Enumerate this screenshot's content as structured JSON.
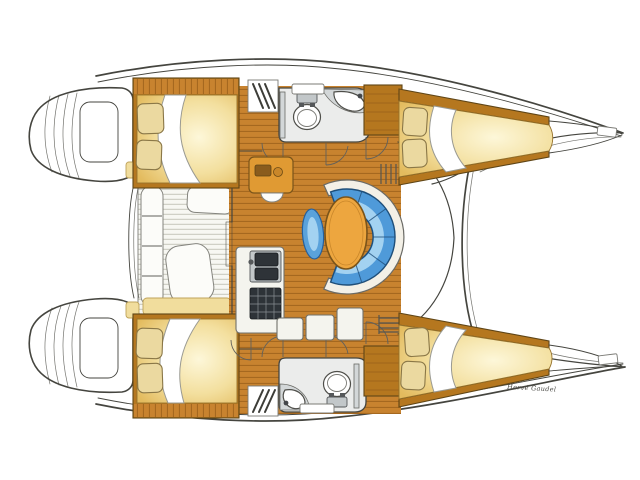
{
  "signature": "Hervé Gaudel",
  "palette": {
    "paper": "#ffffff",
    "outline": "#45453f",
    "wood": "#c8832f",
    "wood_grain": "#9a5f1a",
    "wood_trim": "#b5771f",
    "wood_edge": "#5f4516",
    "mattress": "#f3df9e",
    "mattress_glow": "#fdf7d9",
    "mattress_edge": "#e3bb5e",
    "pillow": "#ebd9a0",
    "pillow_line": "#8a7747",
    "sheet_edge": "#9a9a92",
    "head_floor": "#ebeceb",
    "fixture_gray": "#d3d7d8",
    "sink_steel": "#c2c7c9",
    "counter_white": "#f4f4ee",
    "slat_floor": "#f7f7f2",
    "slat_line": "#c6c6bb",
    "cushion_white": "#fcfcf9",
    "cushion_edge": "#84847e",
    "sun_cushion": "#f1dd9d",
    "sun_edge": "#bfa35a",
    "settee_back": "#f3f0e7",
    "settee_blue": "#4f9ad9",
    "settee_blue_light": "#a8d5f2",
    "settee_blue_edge": "#1f4f7a",
    "stool_blue": "#5aa2db",
    "table_orange": "#eda63f",
    "table_edge": "#7a541a",
    "chart_orange": "#e09a33",
    "steel_dark": "#2e3338",
    "signature_ink": "#4a4a45"
  },
  "features": {
    "port_hull": [
      "aft-double-berth",
      "companionway-steps",
      "head-toilet-sink",
      "wardrobe",
      "forward-double-berth"
    ],
    "starboard_hull": [
      "aft-double-berth",
      "companionway-steps",
      "head-toilet-sink",
      "wardrobe",
      "forward-double-berth"
    ],
    "saloon": [
      "chart-table",
      "c-shaped-settee",
      "oval-table",
      "stool",
      "galley-double-sink",
      "galley-stove",
      "cabinets"
    ],
    "deck": [
      "cockpit-slatted-floor",
      "cockpit-benches",
      "transom-platforms",
      "forward-crossbeam"
    ]
  }
}
